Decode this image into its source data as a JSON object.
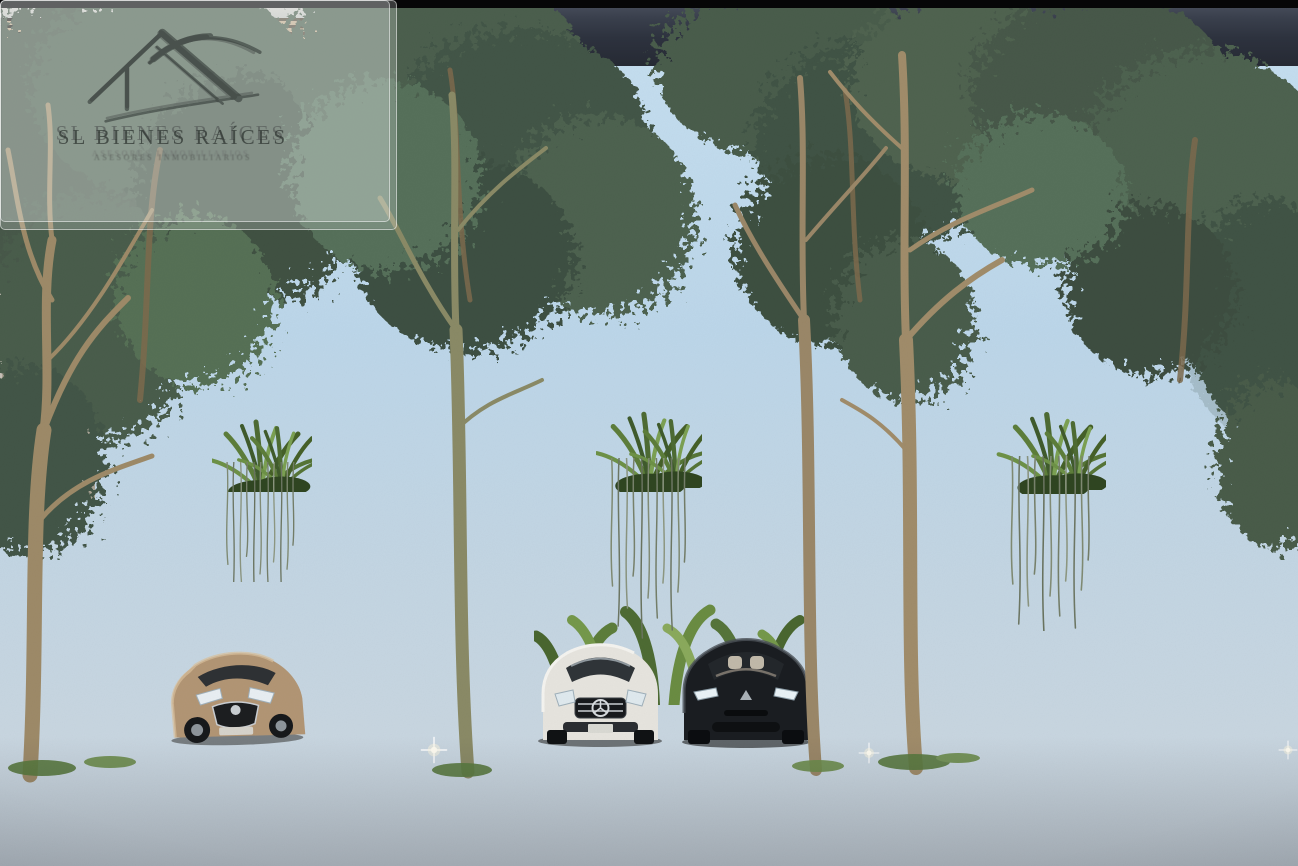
{
  "meta": {
    "type": "architectural-rendering",
    "scene": "Row of three modern two-story townhouses with stone-clad carports, wood slat screens, planter windows with hanging vines, street trees and parked cars on a wet asphalt street at dusk"
  },
  "watermark": {
    "brand": "SL BIENES RAÍCES",
    "tagline": "ASESORES INMOBILIARIOS",
    "logo": "house-roof-swoosh-icon",
    "positions": [
      "top-left",
      "bottom-right"
    ]
  },
  "objects": {
    "houses": 3,
    "cars": [
      {
        "color": "bronze",
        "type": "sedan",
        "position": "left carport"
      },
      {
        "color": "white",
        "type": "sedan",
        "position": "middle carport left"
      },
      {
        "color": "black",
        "type": "sedan",
        "position": "middle carport right"
      },
      {
        "color": "dark",
        "type": "sedan",
        "position": "right carport behind slats"
      }
    ],
    "features": [
      "led-light-strips",
      "stone-carport-walls",
      "wood-slat-screens",
      "planter-windows",
      "hanging-vines",
      "street-trees",
      "bollard-lights",
      "wet-asphalt-reflections"
    ]
  },
  "palette": {
    "sky": "#bdd6e9",
    "foliage": "#4c5f4e",
    "facade": "#d2ccc2",
    "facade_shadow": "#b9b1a4",
    "stone": "#d8cbad",
    "wood": "#bba181",
    "beam": "#6e5f4e",
    "led": "#fff4dc",
    "concrete": "#c9cdd0",
    "asphalt": "#323845",
    "car_bronze": "#b29574",
    "car_white": "#e6e4de",
    "car_black": "#1a1d21"
  }
}
